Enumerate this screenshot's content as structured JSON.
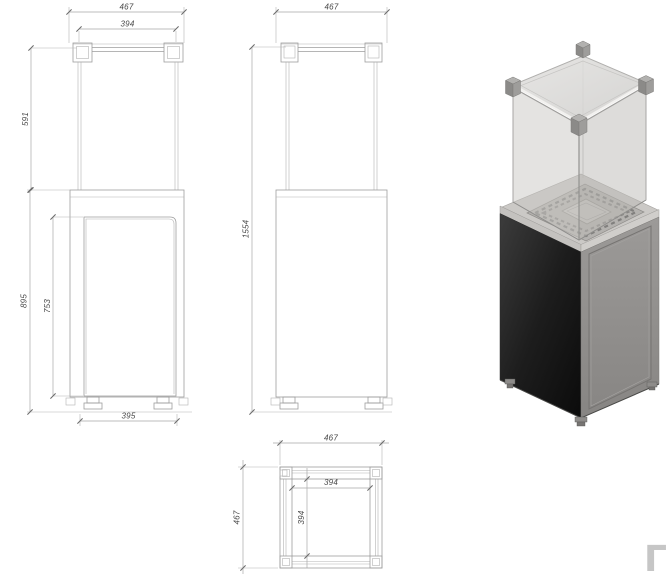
{
  "views": {
    "front": {
      "dim_width_overall": "467",
      "dim_width_glass": "394",
      "dim_glass_height": "591",
      "dim_base_height": "895",
      "dim_door_height": "753",
      "dim_base_width_bottom": "395"
    },
    "side": {
      "dim_width_overall": "467",
      "dim_total_height": "1554"
    },
    "top": {
      "dim_width_overall": "467",
      "dim_width_inner": "394",
      "dim_depth_inner": "394",
      "dim_depth_overall": "467"
    }
  },
  "watermark": {
    "glyph": "Γ"
  },
  "colors": {
    "drawing_line": "#9d9d9d",
    "dimension_text": "#474747",
    "base_dark_face": "#1a1a1a",
    "base_light_face": "#939191",
    "glass_panel": "#c9c7c4",
    "glass_lid": "#dbdad8",
    "burner_plate": "#b4b2af"
  }
}
